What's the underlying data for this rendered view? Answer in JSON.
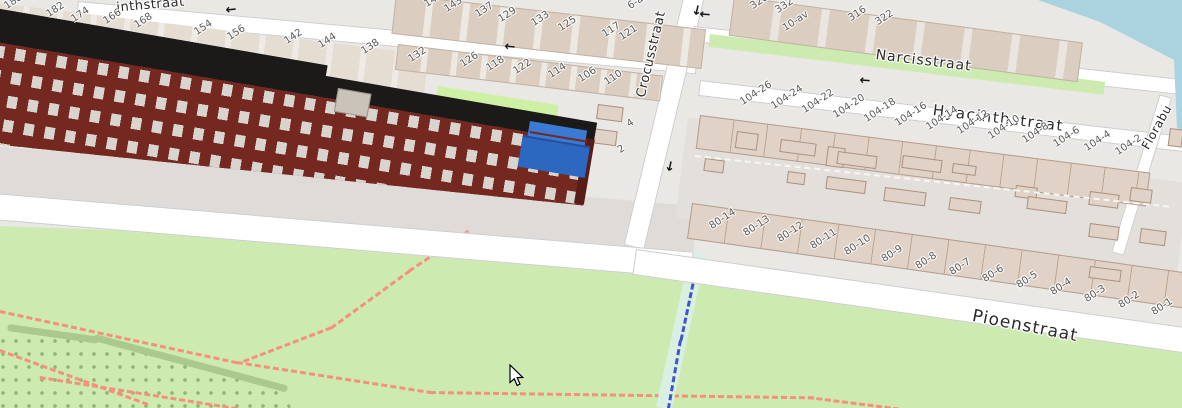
{
  "map": {
    "streets": {
      "top_partial": "inthstraat",
      "crocusstraat": "Crocusstraat",
      "narcisstraat": "Narcisstraat",
      "hyacinthstraat": "Hyacinthstraat",
      "pioenstraat": "Pioenstraat",
      "florabuurt_partial": "Florabu"
    },
    "housenumbers": {
      "top_street_south_west": [
        "188",
        "182",
        "174",
        "166",
        "168",
        "154",
        "156",
        "142",
        "144",
        "138"
      ],
      "top_street_north_east": [
        "141",
        "143",
        "137",
        "129",
        "133",
        "125",
        "117",
        "121",
        "6-aa"
      ],
      "top_street_south_east": [
        "132",
        "126",
        "118",
        "122",
        "114",
        "106",
        "110"
      ],
      "narcisstraat_block": [
        "328",
        "332",
        "10-av",
        "316",
        "322"
      ],
      "hyacinthstraat_row": [
        "104-26",
        "104-24",
        "104-22",
        "104-20",
        "104-18",
        "104-16",
        "104-14",
        "104-12",
        "104-10",
        "104-8",
        "104-6",
        "104-4",
        "104-2"
      ],
      "pioenstraat_row": [
        "80-14",
        "80-13",
        "80-12",
        "80-11",
        "80-10",
        "80-9",
        "80-8",
        "80-7",
        "80-6",
        "80-5",
        "80-4",
        "80-3",
        "80-2",
        "80-1"
      ],
      "crocusstraat_side": [
        "4",
        "2"
      ]
    },
    "oneway_arrow_glyph": "←",
    "selection": {
      "highlighted_building_color": "#2e6fc4"
    },
    "colors": {
      "background_residential": "#eae8e5",
      "park_grass": "#cdebb0",
      "water": "#aad3df",
      "road": "#ffffff",
      "building_footprint": "#ddd0c4",
      "building_3d_wall": "#74281f",
      "building_3d_roof": "#1b1a19",
      "footpath_dashed": "#f4907c",
      "stream_dashed": "#3e56c9"
    },
    "cursor": {
      "visible": true,
      "type": "arrow"
    }
  }
}
